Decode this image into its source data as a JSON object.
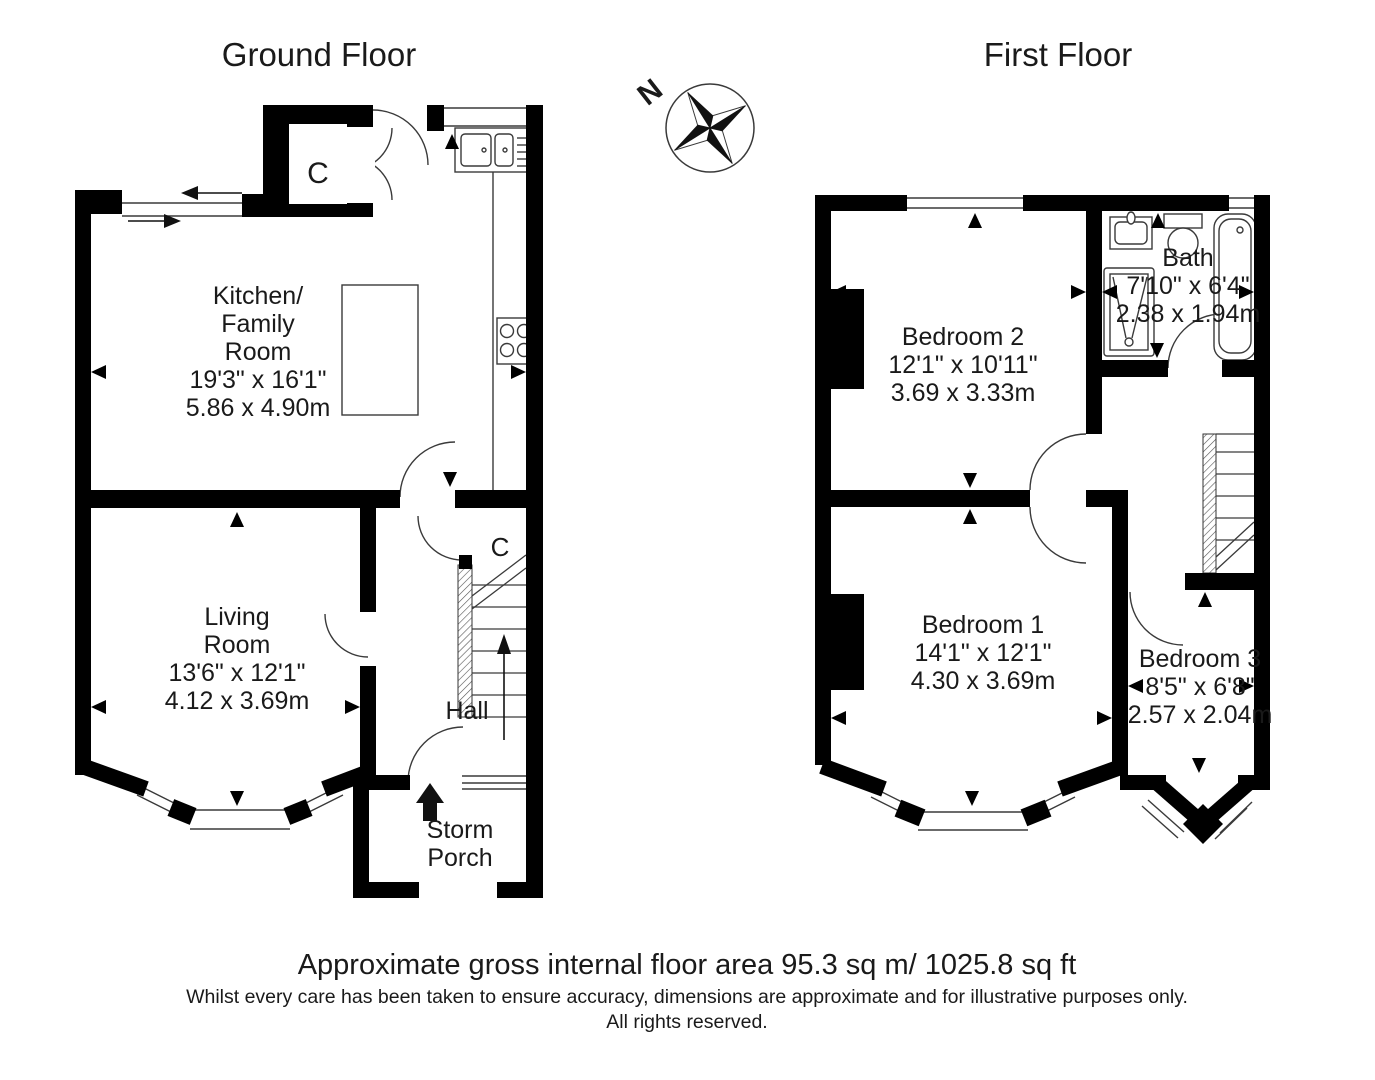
{
  "ground_floor": {
    "title": "Ground Floor",
    "kitchen": {
      "line1": "Kitchen/",
      "line2": "Family",
      "line3": "Room",
      "imperial": "19'3\" x 16'1\"",
      "metric": "5.86 x 4.90m"
    },
    "living": {
      "line1": "Living",
      "line2": "Room",
      "imperial": "13'6\" x 12'1\"",
      "metric": "4.12 x 3.69m"
    },
    "hall": "Hall",
    "storm_porch": {
      "line1": "Storm",
      "line2": "Porch"
    },
    "cupboard_top": "C",
    "cupboard_stairs": "C"
  },
  "first_floor": {
    "title": "First Floor",
    "bedroom2": {
      "name": "Bedroom 2",
      "imperial": "12'1\" x 10'11\"",
      "metric": "3.69 x 3.33m"
    },
    "bath": {
      "name": "Bath",
      "imperial": "7'10\" x 6'4\"",
      "metric": "2.38 x 1.94m"
    },
    "bedroom1": {
      "name": "Bedroom 1",
      "imperial": "14'1\" x 12'1\"",
      "metric": "4.30 x 3.69m"
    },
    "bedroom3": {
      "name": "Bedroom 3",
      "imperial": "8'5\" x 6'8\"",
      "metric": "2.57 x 2.04m"
    }
  },
  "compass": {
    "north_label": "N"
  },
  "footer": {
    "area": "Approximate gross internal floor area 95.3 sq m/ 1025.8 sq ft",
    "disclaimer": "Whilst every care has been taken to ensure accuracy, dimensions are approximate and for illustrative purposes only.",
    "rights": "All rights reserved."
  },
  "colors": {
    "walls": "#000000",
    "lines": "#3a3a3a",
    "background": "#ffffff"
  }
}
